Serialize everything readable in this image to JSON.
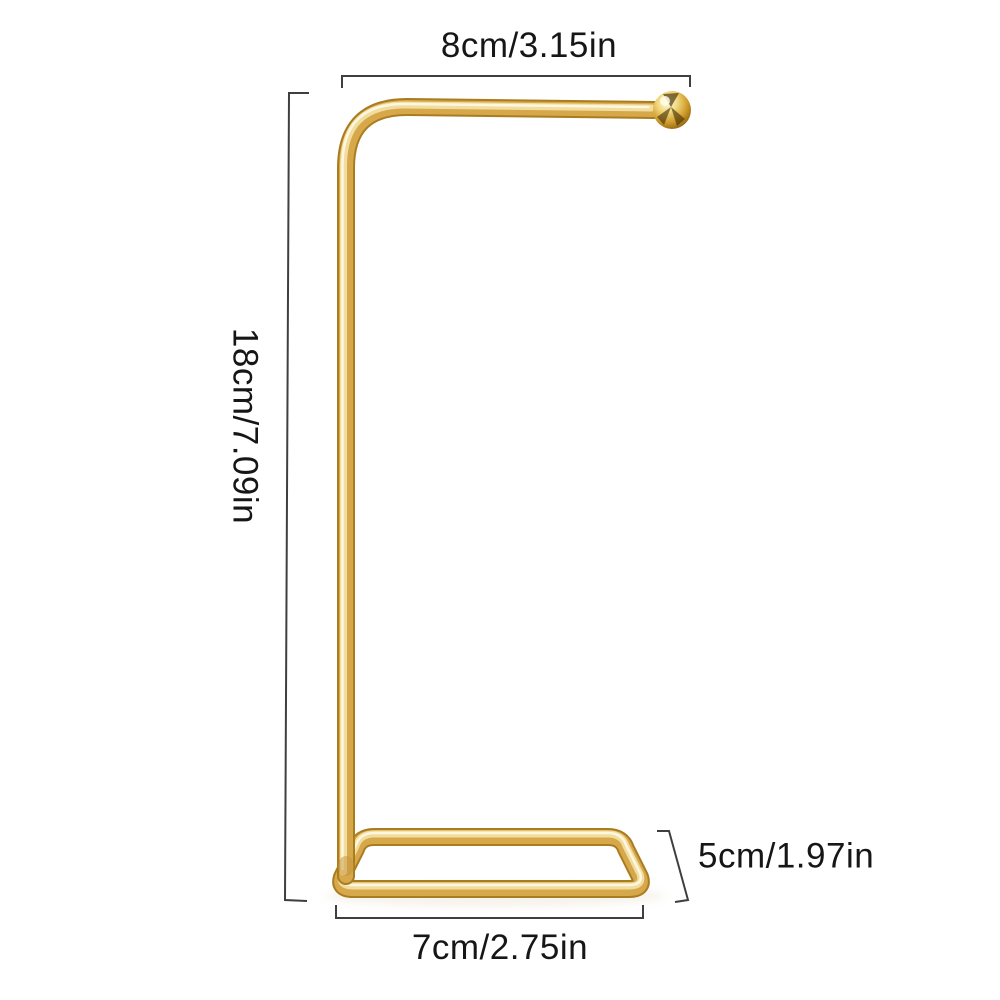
{
  "canvas": {
    "width": 1000,
    "height": 1000,
    "background": "#ffffff"
  },
  "product": {
    "description": "gold metal stand: vertical pole with rounded top corner, horizontal top bar ending in a ball finial, rectangular wire base shown in perspective",
    "colors": {
      "gold_outline": "#aa7c20",
      "gold_mid": "#d6a84a",
      "gold_light": "#f2dda1",
      "gold_highlight": "#fdf7e0",
      "ball_reflection_dark": "#3d2c03",
      "shadow": "#d8c9a8"
    }
  },
  "annotations": {
    "line_color": "#3f3f3f",
    "text_color": "#161616",
    "top": {
      "label": "8cm/3.15in",
      "measures": "top-bar-width"
    },
    "left": {
      "label": "18cm/7.09in",
      "measures": "overall-height"
    },
    "bottom": {
      "label": "7cm/2.75in",
      "measures": "base-width"
    },
    "right": {
      "label": "5cm/1.97in",
      "measures": "base-depth"
    }
  }
}
